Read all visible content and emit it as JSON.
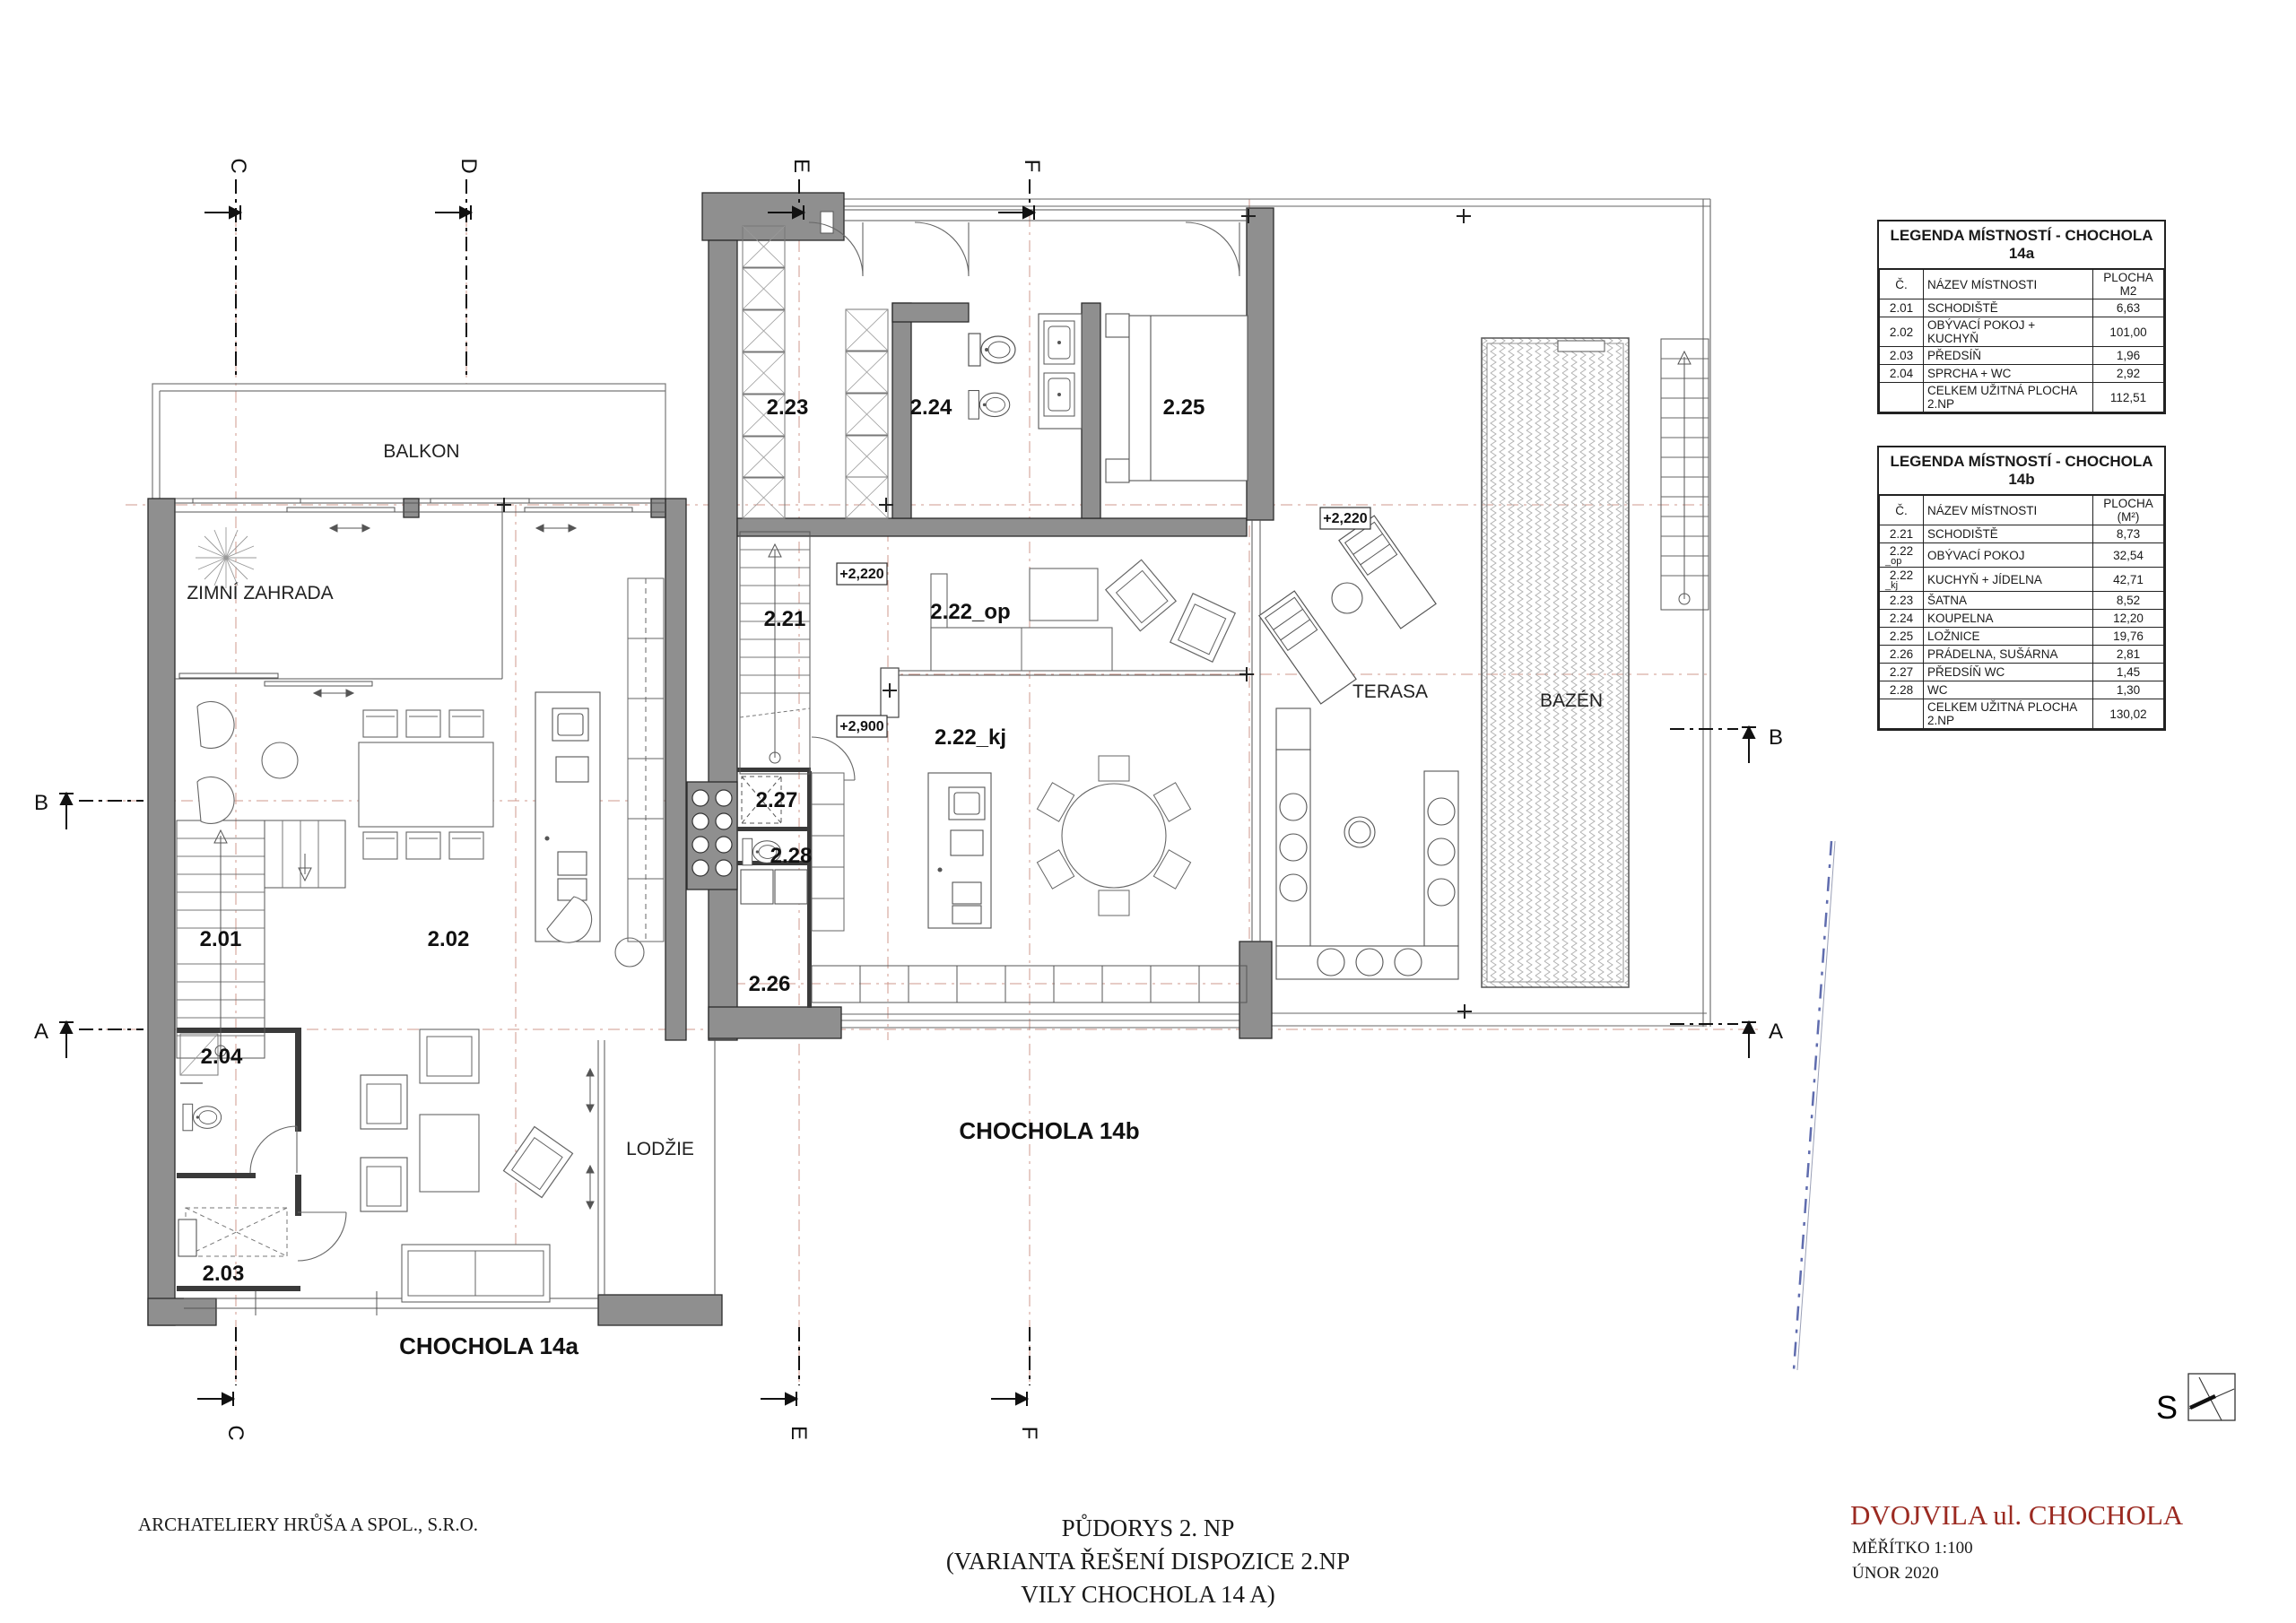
{
  "plan": {
    "labels": {
      "balkon": "BALKON",
      "zimni": "ZIMNÍ ZAHRADA",
      "lodzie": "LODŽIE",
      "terasa": "TERASA",
      "bazen": "BAZÉN",
      "ch14a": "CHOCHOLA 14a",
      "ch14b": "CHOCHOLA 14b",
      "r201": "2.01",
      "r202": "2.02",
      "r203": "2.03",
      "r204": "2.04",
      "r221": "2.21",
      "r222op": "2.22_op",
      "r222kj": "2.22_kj",
      "r223": "2.23",
      "r224": "2.24",
      "r225": "2.25",
      "r226": "2.26",
      "r227": "2.27",
      "r228": "2.28"
    },
    "elevations": {
      "op": "+2,220",
      "terasa": "+2,220",
      "kj": "+2,900"
    },
    "section_top": [
      "C",
      "D",
      "E",
      "F"
    ],
    "section_bottom": [
      "C",
      "E",
      "F"
    ],
    "section_left": [
      "B",
      "A"
    ],
    "section_right": [
      "B",
      "A"
    ],
    "north": "S"
  },
  "legend_a": {
    "title": "LEGENDA MÍSTNOSTÍ - CHOCHOLA 14a",
    "columns": {
      "num": "Č.",
      "name": "NÁZEV MÍSTNOSTI",
      "area": "PLOCHA",
      "area_unit": "M2"
    },
    "rows": [
      {
        "num": "2.01",
        "sub": "",
        "name": "SCHODIŠTĚ",
        "area": "6,63"
      },
      {
        "num": "2.02",
        "sub": "",
        "name": "OBÝVACÍ POKOJ + KUCHYŇ",
        "area": "101,00"
      },
      {
        "num": "2.03",
        "sub": "",
        "name": "PŘEDSÍŇ",
        "area": "1,96"
      },
      {
        "num": "2.04",
        "sub": "",
        "name": "SPRCHA + WC",
        "area": "2,92"
      }
    ],
    "total": {
      "name": "CELKEM UŽITNÁ PLOCHA 2.NP",
      "area": "112,51"
    }
  },
  "legend_b": {
    "title": "LEGENDA MÍSTNOSTÍ - CHOCHOLA 14b",
    "columns": {
      "num": "Č.",
      "name": "NÁZEV MÍSTNOSTI",
      "area": "PLOCHA",
      "area_unit": "(M²)"
    },
    "rows": [
      {
        "num": "2.21",
        "sub": "",
        "name": "SCHODIŠTĚ",
        "area": "8,73"
      },
      {
        "num": "2.22",
        "sub": "_op",
        "name": "OBÝVACÍ POKOJ",
        "area": "32,54"
      },
      {
        "num": "2.22",
        "sub": "_kj",
        "name": "KUCHYŇ + JÍDELNA",
        "area": "42,71"
      },
      {
        "num": "2.23",
        "sub": "",
        "name": "ŠATNA",
        "area": "8,52"
      },
      {
        "num": "2.24",
        "sub": "",
        "name": "KOUPELNA",
        "area": "12,20"
      },
      {
        "num": "2.25",
        "sub": "",
        "name": "LOŽNICE",
        "area": "19,76"
      },
      {
        "num": "2.26",
        "sub": "",
        "name": "PRÁDELNA, SUŠÁRNA",
        "area": "2,81"
      },
      {
        "num": "2.27",
        "sub": "",
        "name": "PŘEDSÍŇ WC",
        "area": "1,45"
      },
      {
        "num": "2.28",
        "sub": "",
        "name": "WC",
        "area": "1,30"
      }
    ],
    "total": {
      "name": "CELKEM UŽITNÁ PLOCHA 2.NP",
      "area": "130,02"
    }
  },
  "title_block": {
    "line1": "PŮDORYS  2. NP",
    "line2": "(VARIANTA ŘEŠENÍ DISPOZICE 2.NP",
    "line3": "VILY CHOCHOLA 14 A)",
    "architect": "ARCHATELIERY HRŮŠA A SPOL., S.R.O.",
    "project": "DVOJVILA  ul. CHOCHOLA",
    "scale": "MĚŘÍTKO 1:100",
    "date": "ÚNOR 2020"
  },
  "colors": {
    "wall": "#8f8f8f",
    "accent_red": "#9b2a21",
    "axis_pink": "#cf9a8d"
  }
}
